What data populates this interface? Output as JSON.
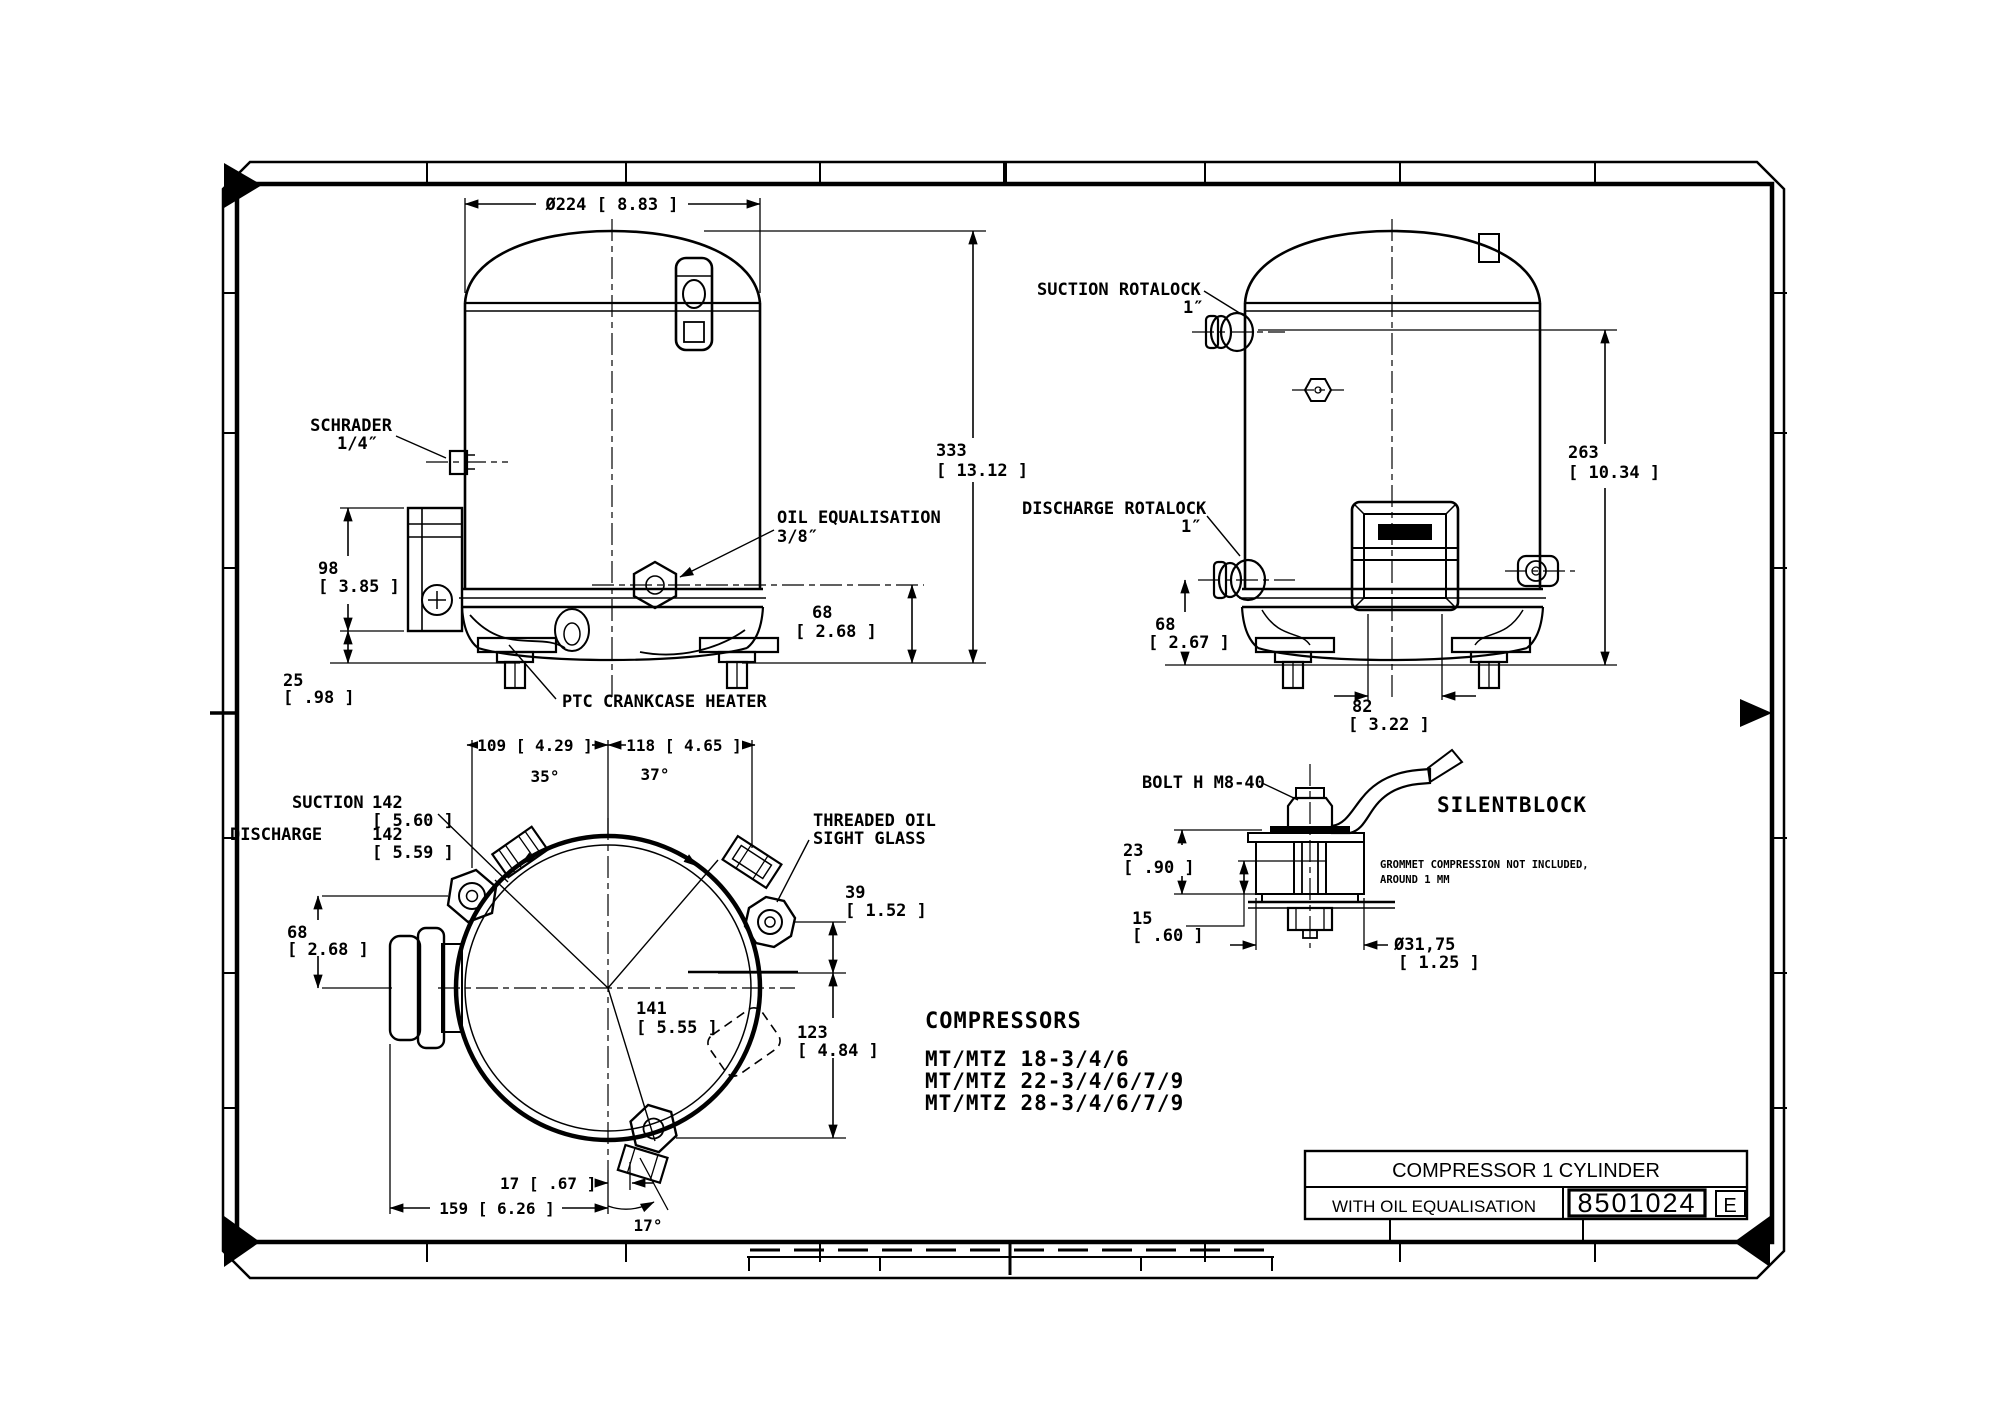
{
  "front": {
    "dia": "Ø224 [ 8.83 ]",
    "schrader_1": "SCHRADER",
    "schrader_2": "1/4″",
    "oil_1": "OIL EQUALISATION",
    "oil_2": "3/8″",
    "ptc": "PTC CRANKCASE HEATER",
    "h333": "333",
    "h333_in": "[ 13.12  ]",
    "h68": "68",
    "h68_in": "[ 2.68 ]",
    "h98": "98",
    "h98_in": "[ 3.85 ]",
    "h25": "25",
    "h25_in": "[ .98 ]"
  },
  "side": {
    "suction_1": "SUCTION ROTALOCK",
    "suction_2": "1″",
    "discharge_1": "DISCHARGE ROTALOCK",
    "discharge_2": "1″",
    "h263": "263",
    "h263_in": "[ 10.34  ]",
    "h68": "68",
    "h68_in": "[ 2.67 ]",
    "w82": "82",
    "w82_in": "[ 3.22 ]"
  },
  "top": {
    "w109": "109  [ 4.29 ]",
    "w118": "118  [ 4.65 ]",
    "a35": "35°",
    "a37": "37°",
    "a17": "17°",
    "suction": "SUCTION",
    "suction_v": "142",
    "suction_in": "[ 5.60 ]",
    "discharge": "DISCHARGE",
    "discharge_v": "142",
    "discharge_in": "[ 5.59 ]",
    "sight_1": "THREADED OIL",
    "sight_2": "SIGHT GLASS",
    "d39": "39",
    "d39_in": "[ 1.52 ]",
    "d123": "123",
    "d123_in": "[ 4.84 ]",
    "d141": "141",
    "d141_in": "[ 5.55 ]",
    "d68": "68",
    "d68_in": "[ 2.68 ]",
    "d17": "17  [ .67 ]",
    "d159": "159  [ 6.26 ]"
  },
  "detail": {
    "bolt": "BOLT H M8-40",
    "title": "SILENTBLOCK",
    "d23": "23",
    "d23_in": "[ .90 ]",
    "d15": "15",
    "d15_in": "[ .60 ]",
    "dia": "Ø31,75",
    "dia_in": "[ 1.25  ]",
    "note_1": "GROMMET COMPRESSION NOT INCLUDED,",
    "note_2": "AROUND 1 MM"
  },
  "list": {
    "heading": "COMPRESSORS",
    "models": [
      "MT/MTZ 18-3/4/6",
      "MT/MTZ 22-3/4/6/7/9",
      "MT/MTZ 28-3/4/6/7/9"
    ]
  },
  "tb": {
    "product": "COMPRESSOR 1 CYLINDER",
    "variant": "WITH OIL EQUALISATION",
    "number": "8501024",
    "rev": "E"
  }
}
